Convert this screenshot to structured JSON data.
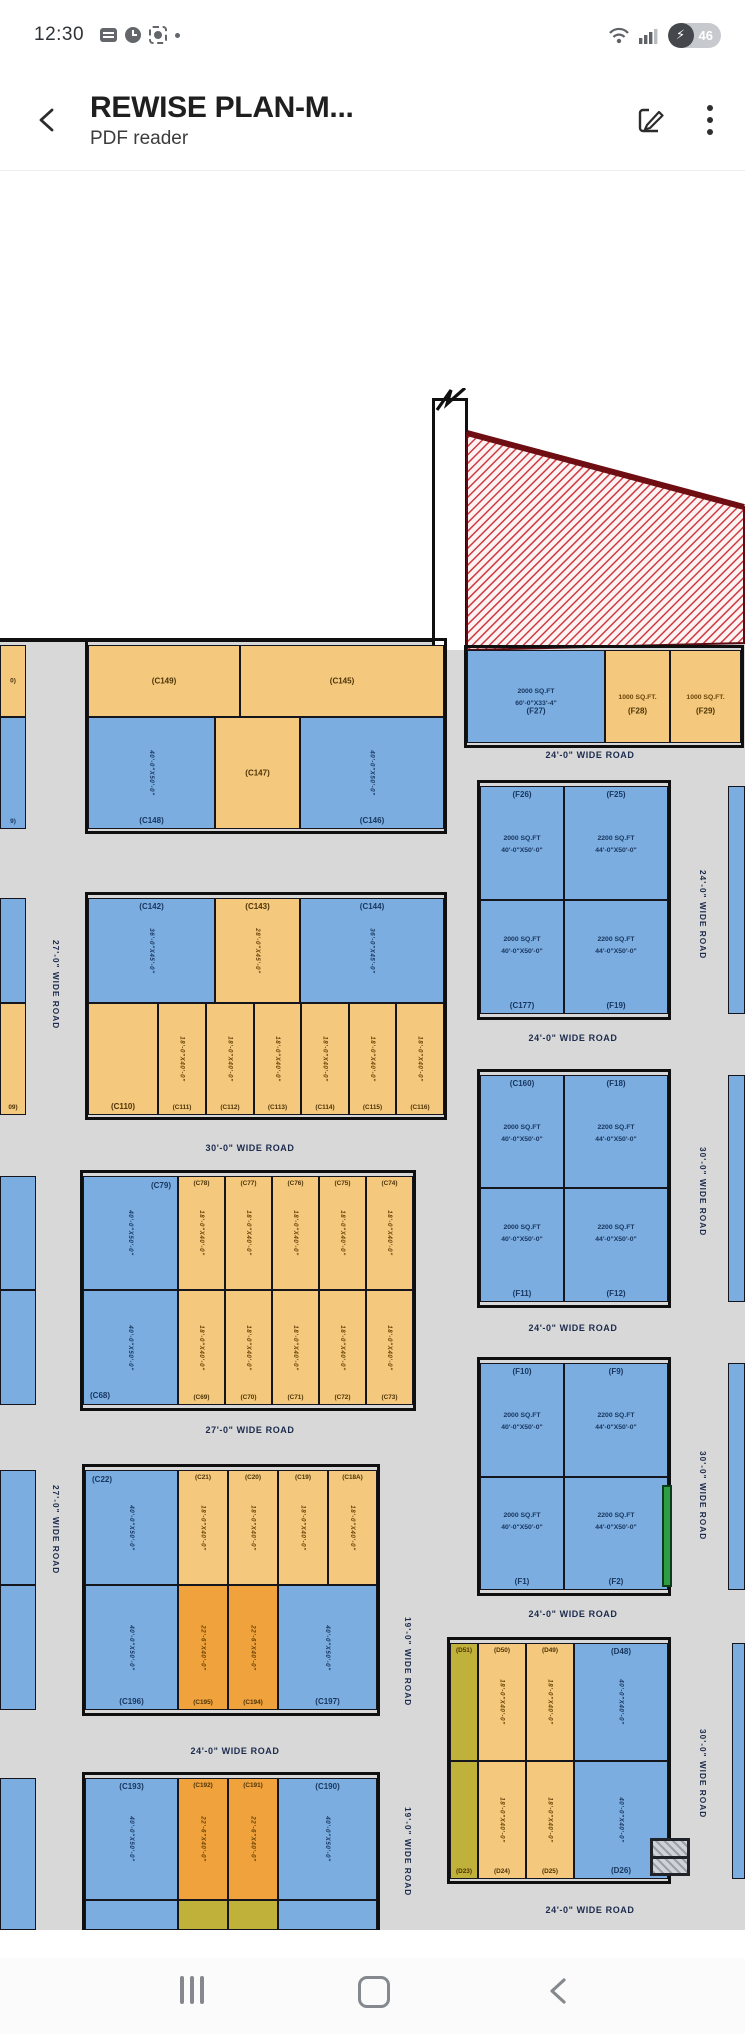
{
  "status_bar": {
    "time": "12:30",
    "battery_percent": "46",
    "bolt": "⚡"
  },
  "app_bar": {
    "title": "REWISE PLAN-M...",
    "subtitle": "PDF reader"
  },
  "plan": {
    "colors": {
      "blue": "#7cade0",
      "tan": "#f4c97e",
      "orange": "#f0a23c",
      "olive": "#bfb13a",
      "road_gray": "#d8d8d8",
      "hatch_red": "#cf3a42",
      "green": "#2e9c44",
      "line": "#101010"
    },
    "blocks": [
      [
        88,
        641,
        356,
        190
      ],
      [
        88,
        895,
        356,
        222
      ],
      [
        83,
        1173,
        330,
        235
      ],
      [
        85,
        1467,
        292,
        246
      ],
      [
        85,
        1775,
        292,
        155
      ],
      [
        467,
        648,
        274,
        97
      ],
      [
        480,
        783,
        188,
        234
      ],
      [
        480,
        1072,
        188,
        233
      ],
      [
        480,
        1360,
        188,
        233
      ],
      [
        450,
        1640,
        218,
        241
      ]
    ],
    "plots": [
      {
        "x": 88,
        "y": 645,
        "w": 152,
        "h": 72,
        "c": "tan",
        "l": "(C149)",
        "lp": "c"
      },
      {
        "x": 240,
        "y": 645,
        "w": 204,
        "h": 72,
        "c": "tan",
        "l": "(C145)",
        "lp": "c"
      },
      {
        "x": 88,
        "y": 717,
        "w": 127,
        "h": 112,
        "c": "blue",
        "l": "(C148)",
        "lp": "b",
        "d": [
          "40'-0\"X50'-0\""
        ],
        "dv": true
      },
      {
        "x": 215,
        "y": 717,
        "w": 85,
        "h": 112,
        "c": "tan",
        "l": "(C147)",
        "lp": "c"
      },
      {
        "x": 300,
        "y": 717,
        "w": 144,
        "h": 112,
        "c": "blue",
        "l": "(C146)",
        "lp": "b",
        "d": [
          "40'-0\"X50'-0\""
        ],
        "dv": true
      },
      {
        "x": 0,
        "y": 645,
        "w": 26,
        "h": 72,
        "c": "tan",
        "l": "0)",
        "lp": "c"
      },
      {
        "x": 0,
        "y": 717,
        "w": 26,
        "h": 112,
        "c": "blue",
        "l": "9)",
        "lp": "b"
      },
      {
        "x": 88,
        "y": 898,
        "w": 127,
        "h": 105,
        "c": "blue",
        "l": "(C142)",
        "lp": "t",
        "d": [
          "36'-0\"X45'-0\""
        ],
        "dv": true
      },
      {
        "x": 215,
        "y": 898,
        "w": 85,
        "h": 105,
        "c": "tan",
        "l": "(C143)",
        "lp": "t",
        "d": [
          "28'-0\"X45'-0\""
        ],
        "dv": true
      },
      {
        "x": 300,
        "y": 898,
        "w": 144,
        "h": 105,
        "c": "blue",
        "l": "(C144)",
        "lp": "t",
        "d": [
          "36'-0\"X45'-0\""
        ],
        "dv": true
      },
      {
        "x": 88,
        "y": 1003,
        "w": 70,
        "h": 112,
        "c": "tan",
        "l": "(C110)",
        "lp": "b"
      },
      {
        "x": 158,
        "y": 1003,
        "w": 48,
        "h": 112,
        "c": "tan",
        "l": "(C111)",
        "lp": "b",
        "d": [
          "18'-0\"X40'-0\""
        ],
        "dv": true
      },
      {
        "x": 206,
        "y": 1003,
        "w": 48,
        "h": 112,
        "c": "tan",
        "l": "(C112)",
        "lp": "b",
        "d": [
          "18'-0\"X40'-0\""
        ],
        "dv": true
      },
      {
        "x": 254,
        "y": 1003,
        "w": 47,
        "h": 112,
        "c": "tan",
        "l": "(C113)",
        "lp": "b",
        "d": [
          "18'-0\"X40'-0\""
        ],
        "dv": true
      },
      {
        "x": 301,
        "y": 1003,
        "w": 48,
        "h": 112,
        "c": "tan",
        "l": "(C114)",
        "lp": "b",
        "d": [
          "18'-0\"X40'-0\""
        ],
        "dv": true
      },
      {
        "x": 349,
        "y": 1003,
        "w": 47,
        "h": 112,
        "c": "tan",
        "l": "(C115)",
        "lp": "b",
        "d": [
          "18'-0\"X40'-0\""
        ],
        "dv": true
      },
      {
        "x": 396,
        "y": 1003,
        "w": 48,
        "h": 112,
        "c": "tan",
        "l": "(C116)",
        "lp": "b",
        "d": [
          "18'-0\"X40'-0\""
        ],
        "dv": true
      },
      {
        "x": 0,
        "y": 898,
        "w": 26,
        "h": 105,
        "c": "blue",
        "l": "",
        "lp": "c"
      },
      {
        "x": 0,
        "y": 1003,
        "w": 26,
        "h": 112,
        "c": "tan",
        "l": "09)",
        "lp": "b"
      },
      {
        "x": 83,
        "y": 1176,
        "w": 95,
        "h": 114,
        "c": "blue",
        "l": "(C79)",
        "lp": "tr",
        "d": [
          "40'-0\"X50'-0\""
        ],
        "dv": true
      },
      {
        "x": 178,
        "y": 1176,
        "w": 47,
        "h": 114,
        "c": "tan",
        "l": "(C78)",
        "lp": "t",
        "d": [
          "18'-0\"X40'-0\""
        ],
        "dv": true
      },
      {
        "x": 225,
        "y": 1176,
        "w": 47,
        "h": 114,
        "c": "tan",
        "l": "(C77)",
        "lp": "t",
        "d": [
          "18'-0\"X40'-0\""
        ],
        "dv": true
      },
      {
        "x": 272,
        "y": 1176,
        "w": 47,
        "h": 114,
        "c": "tan",
        "l": "(C76)",
        "lp": "t",
        "d": [
          "18'-0\"X40'-0\""
        ],
        "dv": true
      },
      {
        "x": 319,
        "y": 1176,
        "w": 47,
        "h": 114,
        "c": "tan",
        "l": "(C75)",
        "lp": "t",
        "d": [
          "18'-0\"X40'-0\""
        ],
        "dv": true
      },
      {
        "x": 366,
        "y": 1176,
        "w": 47,
        "h": 114,
        "c": "tan",
        "l": "(C74)",
        "lp": "t",
        "d": [
          "18'-0\"X40'-0\""
        ],
        "dv": true
      },
      {
        "x": 83,
        "y": 1290,
        "w": 95,
        "h": 115,
        "c": "blue",
        "l": "(C68)",
        "lp": "bl",
        "d": [
          "40'-0\"X50'-0\""
        ],
        "dv": true
      },
      {
        "x": 178,
        "y": 1290,
        "w": 47,
        "h": 115,
        "c": "tan",
        "l": "(C69)",
        "lp": "b",
        "d": [
          "18'-0\"X40'-0\""
        ],
        "dv": true
      },
      {
        "x": 225,
        "y": 1290,
        "w": 47,
        "h": 115,
        "c": "tan",
        "l": "(C70)",
        "lp": "b",
        "d": [
          "18'-0\"X40'-0\""
        ],
        "dv": true
      },
      {
        "x": 272,
        "y": 1290,
        "w": 47,
        "h": 115,
        "c": "tan",
        "l": "(C71)",
        "lp": "b",
        "d": [
          "18'-0\"X40'-0\""
        ],
        "dv": true
      },
      {
        "x": 319,
        "y": 1290,
        "w": 47,
        "h": 115,
        "c": "tan",
        "l": "(C72)",
        "lp": "b",
        "d": [
          "18'-0\"X40'-0\""
        ],
        "dv": true
      },
      {
        "x": 366,
        "y": 1290,
        "w": 47,
        "h": 115,
        "c": "tan",
        "l": "(C73)",
        "lp": "b",
        "d": [
          "18'-0\"X40'-0\""
        ],
        "dv": true
      },
      {
        "x": 0,
        "y": 1176,
        "w": 36,
        "h": 114,
        "c": "blue",
        "l": "",
        "lp": "c"
      },
      {
        "x": 0,
        "y": 1290,
        "w": 36,
        "h": 115,
        "c": "blue",
        "l": "",
        "lp": "c"
      },
      {
        "x": 85,
        "y": 1470,
        "w": 93,
        "h": 115,
        "c": "blue",
        "l": "(C22)",
        "lp": "tl",
        "d": [
          "40'-0\"X50'-0\""
        ],
        "dv": true
      },
      {
        "x": 178,
        "y": 1470,
        "w": 50,
        "h": 115,
        "c": "tan",
        "l": "(C21)",
        "lp": "t",
        "d": [
          "18'-0\"X40'-0\""
        ],
        "dv": true
      },
      {
        "x": 228,
        "y": 1470,
        "w": 50,
        "h": 115,
        "c": "tan",
        "l": "(C20)",
        "lp": "t",
        "d": [
          "18'-0\"X40'-0\""
        ],
        "dv": true
      },
      {
        "x": 278,
        "y": 1470,
        "w": 50,
        "h": 115,
        "c": "tan",
        "l": "(C19)",
        "lp": "t",
        "d": [
          "18'-0\"X40'-0\""
        ],
        "dv": true
      },
      {
        "x": 328,
        "y": 1470,
        "w": 49,
        "h": 115,
        "c": "tan",
        "l": "(C18A)",
        "lp": "t",
        "d": [
          "18'-0\"X40'-0\""
        ],
        "dv": true
      },
      {
        "x": 85,
        "y": 1585,
        "w": 93,
        "h": 125,
        "c": "blue",
        "l": "(C196)",
        "lp": "b",
        "d": [
          "40'-0\"X50'-0\""
        ],
        "dv": true
      },
      {
        "x": 178,
        "y": 1585,
        "w": 50,
        "h": 125,
        "c": "orange",
        "l": "(C195)",
        "lp": "b",
        "d": [
          "22'-6\"X40'-0\""
        ],
        "dv": true
      },
      {
        "x": 228,
        "y": 1585,
        "w": 50,
        "h": 125,
        "c": "orange",
        "l": "(C194)",
        "lp": "b",
        "d": [
          "22'-6\"X40'-0\""
        ],
        "dv": true
      },
      {
        "x": 278,
        "y": 1585,
        "w": 99,
        "h": 125,
        "c": "blue",
        "l": "(C197)",
        "lp": "b",
        "d": [
          "40'-0\"X50'-0\""
        ],
        "dv": true
      },
      {
        "x": 0,
        "y": 1470,
        "w": 36,
        "h": 115,
        "c": "blue",
        "l": "",
        "lp": "c"
      },
      {
        "x": 0,
        "y": 1585,
        "w": 36,
        "h": 125,
        "c": "blue",
        "l": "",
        "lp": "c"
      },
      {
        "x": 85,
        "y": 1778,
        "w": 93,
        "h": 122,
        "c": "blue",
        "l": "(C193)",
        "lp": "t",
        "d": [
          "40'-0\"X50'-0\""
        ],
        "dv": true
      },
      {
        "x": 178,
        "y": 1778,
        "w": 50,
        "h": 122,
        "c": "orange",
        "l": "(C192)",
        "lp": "t",
        "d": [
          "22'-6\"X40'-0\""
        ],
        "dv": true
      },
      {
        "x": 228,
        "y": 1778,
        "w": 50,
        "h": 122,
        "c": "orange",
        "l": "(C191)",
        "lp": "t",
        "d": [
          "22'-6\"X40'-0\""
        ],
        "dv": true
      },
      {
        "x": 278,
        "y": 1778,
        "w": 99,
        "h": 122,
        "c": "blue",
        "l": "(C190)",
        "lp": "t",
        "d": [
          "40'-0\"X50'-0\""
        ],
        "dv": true
      },
      {
        "x": 0,
        "y": 1778,
        "w": 36,
        "h": 152,
        "c": "blue",
        "l": "",
        "lp": "c"
      },
      {
        "x": 85,
        "y": 1900,
        "w": 93,
        "h": 30,
        "c": "blue",
        "l": "",
        "lp": "c"
      },
      {
        "x": 178,
        "y": 1900,
        "w": 50,
        "h": 30,
        "c": "olive",
        "l": "",
        "lp": "c"
      },
      {
        "x": 228,
        "y": 1900,
        "w": 50,
        "h": 30,
        "c": "olive",
        "l": "",
        "lp": "c"
      },
      {
        "x": 278,
        "y": 1900,
        "w": 99,
        "h": 30,
        "c": "blue",
        "l": "",
        "lp": "c"
      },
      {
        "x": 467,
        "y": 650,
        "w": 138,
        "h": 93,
        "c": "blue",
        "l": "(F27)",
        "lp": "cb",
        "d": [
          "2000 SQ.FT",
          "60'-0\"X33'-4\""
        ]
      },
      {
        "x": 605,
        "y": 650,
        "w": 65,
        "h": 93,
        "c": "tan",
        "l": "(F28)",
        "lp": "cb",
        "d": [
          "1000 SQ.FT."
        ]
      },
      {
        "x": 670,
        "y": 650,
        "w": 71,
        "h": 93,
        "c": "tan",
        "l": "(F29)",
        "lp": "cb",
        "d": [
          "1000 SQ.FT."
        ]
      },
      {
        "x": 480,
        "y": 786,
        "w": 84,
        "h": 114,
        "c": "blue",
        "l": "(F26)",
        "lp": "t",
        "d": [
          "2000 SQ.FT",
          "40'-0\"X50'-0\""
        ]
      },
      {
        "x": 564,
        "y": 786,
        "w": 104,
        "h": 114,
        "c": "blue",
        "l": "(F25)",
        "lp": "t",
        "d": [
          "2200 SQ.FT",
          "44'-0\"X50'-0\""
        ]
      },
      {
        "x": 480,
        "y": 900,
        "w": 84,
        "h": 114,
        "c": "blue",
        "l": "(C177)",
        "lp": "b",
        "d": [
          "2000 SQ.FT",
          "40'-0\"X50'-0\""
        ]
      },
      {
        "x": 564,
        "y": 900,
        "w": 104,
        "h": 114,
        "c": "blue",
        "l": "(F19)",
        "lp": "b",
        "d": [
          "2200 SQ.FT",
          "44'-0\"X50'-0\""
        ]
      },
      {
        "x": 480,
        "y": 1075,
        "w": 84,
        "h": 113,
        "c": "blue",
        "l": "(C160)",
        "lp": "t",
        "d": [
          "2000 SQ.FT",
          "40'-0\"X50'-0\""
        ]
      },
      {
        "x": 564,
        "y": 1075,
        "w": 104,
        "h": 113,
        "c": "blue",
        "l": "(F18)",
        "lp": "t",
        "d": [
          "2200 SQ.FT",
          "44'-0\"X50'-0\""
        ]
      },
      {
        "x": 480,
        "y": 1188,
        "w": 84,
        "h": 114,
        "c": "blue",
        "l": "(F11)",
        "lp": "b",
        "d": [
          "2000 SQ.FT",
          "40'-0\"X50'-0\""
        ]
      },
      {
        "x": 564,
        "y": 1188,
        "w": 104,
        "h": 114,
        "c": "blue",
        "l": "(F12)",
        "lp": "b",
        "d": [
          "2200 SQ.FT",
          "44'-0\"X50'-0\""
        ]
      },
      {
        "x": 480,
        "y": 1363,
        "w": 84,
        "h": 114,
        "c": "blue",
        "l": "(F10)",
        "lp": "t",
        "d": [
          "2000 SQ.FT",
          "40'-0\"X50'-0\""
        ]
      },
      {
        "x": 564,
        "y": 1363,
        "w": 104,
        "h": 114,
        "c": "blue",
        "l": "(F9)",
        "lp": "t",
        "d": [
          "2200 SQ.FT",
          "44'-0\"X50'-0\""
        ]
      },
      {
        "x": 480,
        "y": 1477,
        "w": 84,
        "h": 113,
        "c": "blue",
        "l": "(F1)",
        "lp": "b",
        "d": [
          "2000 SQ.FT",
          "40'-0\"X50'-0\""
        ]
      },
      {
        "x": 564,
        "y": 1477,
        "w": 104,
        "h": 113,
        "c": "blue",
        "l": "(F2)",
        "lp": "b",
        "d": [
          "2200 SQ.FT",
          "44'-0\"X50'-0\""
        ]
      },
      {
        "x": 450,
        "y": 1643,
        "w": 28,
        "h": 118,
        "c": "olive",
        "l": "(D51)",
        "lp": "t"
      },
      {
        "x": 478,
        "y": 1643,
        "w": 48,
        "h": 118,
        "c": "tan",
        "l": "(D50)",
        "lp": "t",
        "d": [
          "18'-0\"X40'-0\""
        ],
        "dv": true
      },
      {
        "x": 526,
        "y": 1643,
        "w": 48,
        "h": 118,
        "c": "tan",
        "l": "(D49)",
        "lp": "t",
        "d": [
          "18'-0\"X40'-0\""
        ],
        "dv": true
      },
      {
        "x": 574,
        "y": 1643,
        "w": 94,
        "h": 118,
        "c": "blue",
        "l": "(D48)",
        "lp": "t",
        "d": [
          "40'-0\"X40'-0\""
        ],
        "dv": true
      },
      {
        "x": 450,
        "y": 1761,
        "w": 28,
        "h": 118,
        "c": "olive",
        "l": "(D23)",
        "lp": "b"
      },
      {
        "x": 478,
        "y": 1761,
        "w": 48,
        "h": 118,
        "c": "tan",
        "l": "(D24)",
        "lp": "b",
        "d": [
          "18'-0\"X40'-0\""
        ],
        "dv": true
      },
      {
        "x": 526,
        "y": 1761,
        "w": 48,
        "h": 118,
        "c": "tan",
        "l": "(D25)",
        "lp": "b",
        "d": [
          "18'-0\"X40'-0\""
        ],
        "dv": true
      },
      {
        "x": 574,
        "y": 1761,
        "w": 94,
        "h": 118,
        "c": "blue",
        "l": "(D26)",
        "lp": "b",
        "d": [
          "40'-0\"X40'-0\""
        ],
        "dv": true
      },
      {
        "x": 728,
        "y": 786,
        "w": 17,
        "h": 228,
        "c": "blue",
        "l": "",
        "lp": "c"
      },
      {
        "x": 728,
        "y": 1075,
        "w": 17,
        "h": 227,
        "c": "blue",
        "l": "",
        "lp": "c"
      },
      {
        "x": 728,
        "y": 1363,
        "w": 17,
        "h": 227,
        "c": "blue",
        "l": "",
        "lp": "c"
      },
      {
        "x": 732,
        "y": 1643,
        "w": 13,
        "h": 236,
        "c": "blue",
        "l": "",
        "lp": "c"
      }
    ],
    "road_labels": [
      {
        "text": "24'-0\" WIDE ROAD",
        "x": 590,
        "y": 757
      },
      {
        "text": "24'-0\" WIDE ROAD",
        "x": 573,
        "y": 1040
      },
      {
        "text": "24'-0\" WIDE ROAD",
        "x": 573,
        "y": 1330
      },
      {
        "text": "24'-0\" WIDE ROAD",
        "x": 573,
        "y": 1616
      },
      {
        "text": "24'-0\" WIDE ROAD",
        "x": 590,
        "y": 1912
      },
      {
        "text": "30'-0\" WIDE ROAD",
        "x": 250,
        "y": 1150
      },
      {
        "text": "27'-0\" WIDE ROAD",
        "x": 250,
        "y": 1432
      },
      {
        "text": "24'-0\" WIDE ROAD",
        "x": 235,
        "y": 1753
      },
      {
        "text": "27'-0\" WIDE ROAD",
        "x": 52,
        "y": 985,
        "v": true
      },
      {
        "text": "27'-0\" WIDE ROAD",
        "x": 52,
        "y": 1530,
        "v": true
      },
      {
        "text": "19'-0\" WIDE ROAD",
        "x": 404,
        "y": 1662,
        "v": true
      },
      {
        "text": "19'-0\" WIDE ROAD",
        "x": 404,
        "y": 1852,
        "v": true
      },
      {
        "text": "24'-0\" WIDE ROAD",
        "x": 699,
        "y": 915,
        "v": true
      },
      {
        "text": "30'-0\" WIDE ROAD",
        "x": 699,
        "y": 1192,
        "v": true
      },
      {
        "text": "30'-0\" WIDE ROAD",
        "x": 699,
        "y": 1496,
        "v": true
      },
      {
        "text": "30'-0\" WIDE ROAD",
        "x": 699,
        "y": 1774,
        "v": true
      }
    ]
  }
}
